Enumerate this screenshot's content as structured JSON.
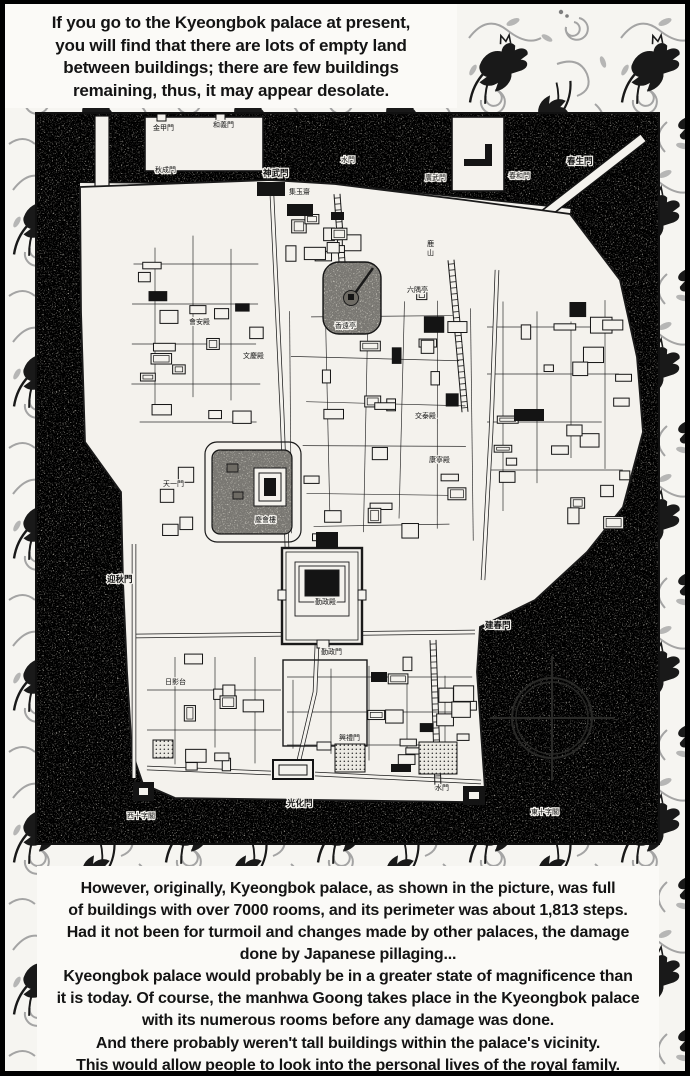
{
  "top_caption": {
    "lines": [
      "If you go to the Kyeongbok palace at present,",
      "you will find that there are lots of empty land",
      "between buildings; there are few buildings",
      "remaining, thus, it may appear desolate."
    ]
  },
  "bottom_caption": {
    "lines": [
      "However, originally, Kyeongbok palace, as shown in the picture, was full",
      "of buildings with over 7000 rooms, and its perimeter was about 1,813 steps.",
      "Had it not been for turmoil and changes made by other palaces, the damage",
      "done by Japanese pillaging...",
      "Kyeongbok palace would probably be in a greater state of magnificence than",
      "it is today. Of course, the manhwa Goong takes place in the Kyeongbok palace",
      "with its numerous rooms before any damage was done.",
      "And there probably weren't tall buildings within the palace's vicinity.",
      "This would allow people to look into the personal lives of the royal family."
    ]
  },
  "map": {
    "subject": "Plan of Kyeongbok Palace grounds",
    "labels": [
      {
        "text": "金甲門",
        "x": 118,
        "y": 18
      },
      {
        "text": "和義門",
        "x": 178,
        "y": 15
      },
      {
        "text": "秋成門",
        "x": 120,
        "y": 60
      },
      {
        "text": "神武門",
        "x": 228,
        "y": 64,
        "major": true
      },
      {
        "text": "水門",
        "x": 306,
        "y": 50
      },
      {
        "text": "集玉齋",
        "x": 254,
        "y": 82
      },
      {
        "text": "廣武門",
        "x": 390,
        "y": 68
      },
      {
        "text": "春和門",
        "x": 474,
        "y": 66
      },
      {
        "text": "春生門",
        "x": 532,
        "y": 52,
        "major": true
      },
      {
        "text": "鹿山",
        "x": 392,
        "y": 134,
        "vertical": true
      },
      {
        "text": "會安殿",
        "x": 154,
        "y": 212
      },
      {
        "text": "文慶殿",
        "x": 208,
        "y": 246
      },
      {
        "text": "六隅亭",
        "x": 372,
        "y": 180
      },
      {
        "text": "香遠亭",
        "x": 300,
        "y": 216
      },
      {
        "text": "天一門",
        "x": 128,
        "y": 374
      },
      {
        "text": "慶會樓",
        "x": 220,
        "y": 410
      },
      {
        "text": "交泰殿",
        "x": 380,
        "y": 306
      },
      {
        "text": "康寧殿",
        "x": 394,
        "y": 350
      },
      {
        "text": "迎秋門",
        "x": 72,
        "y": 470,
        "major": true
      },
      {
        "text": "建春門",
        "x": 450,
        "y": 516,
        "major": true
      },
      {
        "text": "勤政殿",
        "x": 280,
        "y": 492
      },
      {
        "text": "勤政門",
        "x": 286,
        "y": 542
      },
      {
        "text": "日影台",
        "x": 130,
        "y": 572
      },
      {
        "text": "興禮門",
        "x": 304,
        "y": 628
      },
      {
        "text": "光化門",
        "x": 252,
        "y": 694,
        "major": true
      },
      {
        "text": "西十字閣",
        "x": 92,
        "y": 706
      },
      {
        "text": "東十字閣",
        "x": 496,
        "y": 702
      },
      {
        "text": "水門",
        "x": 400,
        "y": 678
      }
    ]
  },
  "colors": {
    "ink": "#141414",
    "paper": "#f7f6f2",
    "terrain_gray": "#b0ada5",
    "pattern_gray": "#9b9b9b"
  }
}
